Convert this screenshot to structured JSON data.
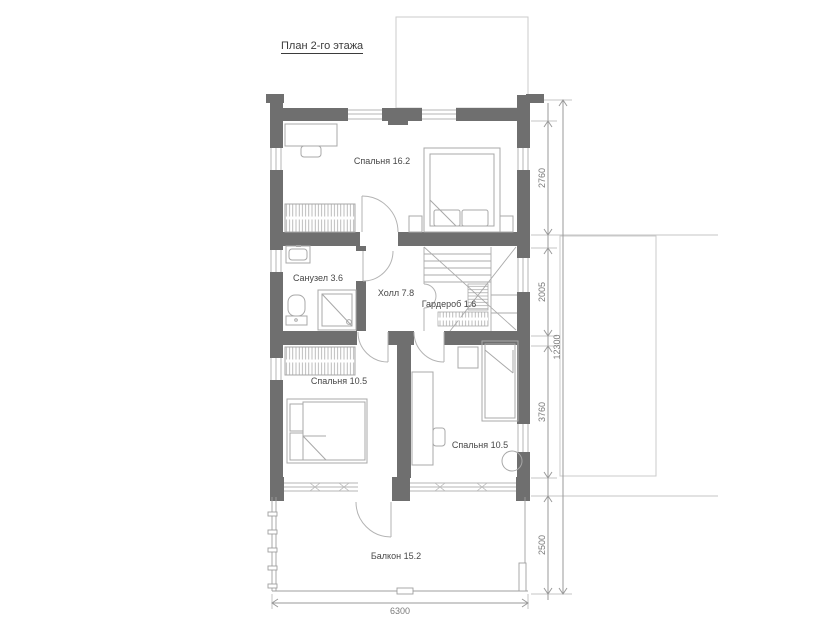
{
  "title": "План 2-го этажа",
  "rooms": {
    "bedroom_top": "Спальня 16.2",
    "bathroom": "Санузел 3.6",
    "hall": "Холл 7.8",
    "wardrobe": "Гардероб 1.6",
    "bedroom_left": "Спальня 10.5",
    "bedroom_right": "Спальня 10.5",
    "balcony": "Балкон 15.2"
  },
  "dimensions": {
    "right_chain": [
      "2760",
      "2005",
      "3760",
      "2500"
    ],
    "total_height": "12300",
    "bottom_width": "6300"
  },
  "colors": {
    "wall": "#6f6f6f",
    "furniture_line": "#a8a8a8",
    "window_line": "#b5b5b5",
    "dimension_line": "#9a9a9a",
    "label_text": "#474747"
  }
}
